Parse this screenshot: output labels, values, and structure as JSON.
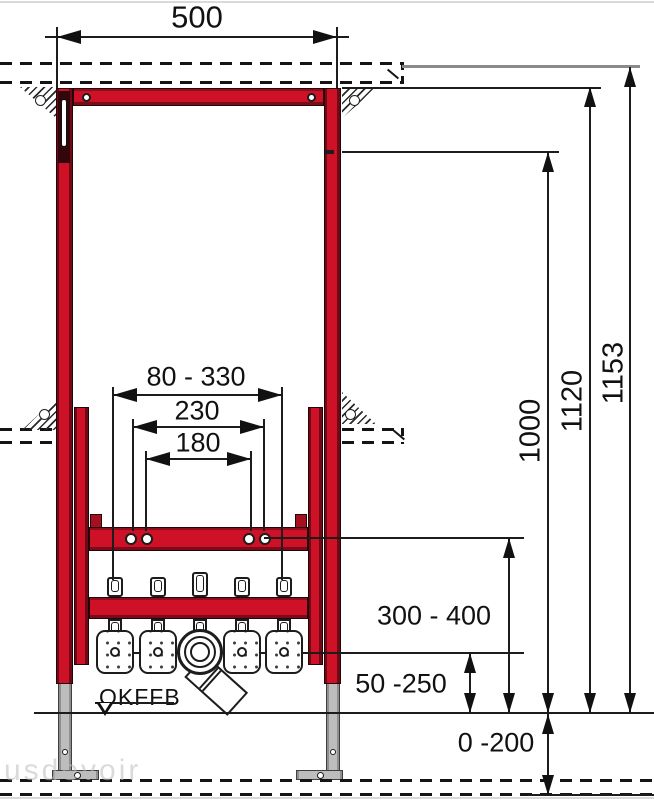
{
  "diagram": {
    "type": "technical-installation-drawing",
    "subject": "Concealed bidet installation frame, front view with mounting dimensions in mm",
    "colors": {
      "frame_red": "#ce1126",
      "line_black": "#1c1c1c",
      "support_gray": "#bdbdbd",
      "ref_gray": "#8a8a8a"
    },
    "dims": {
      "width": {
        "label": "500"
      },
      "range": {
        "label": "80 - 330"
      },
      "d230": {
        "label": "230"
      },
      "d180": {
        "label": "180"
      },
      "h1000": {
        "label": "1000"
      },
      "h1120": {
        "label": "1120"
      },
      "h1153": {
        "label": "1153"
      },
      "outlet": {
        "label": "300 - 400"
      },
      "trap": {
        "label": "50 -250"
      },
      "feet": {
        "label": "0 -200"
      }
    },
    "annotations": {
      "floor_datum": "OKFFB",
      "watermark": "usdevoir"
    }
  }
}
